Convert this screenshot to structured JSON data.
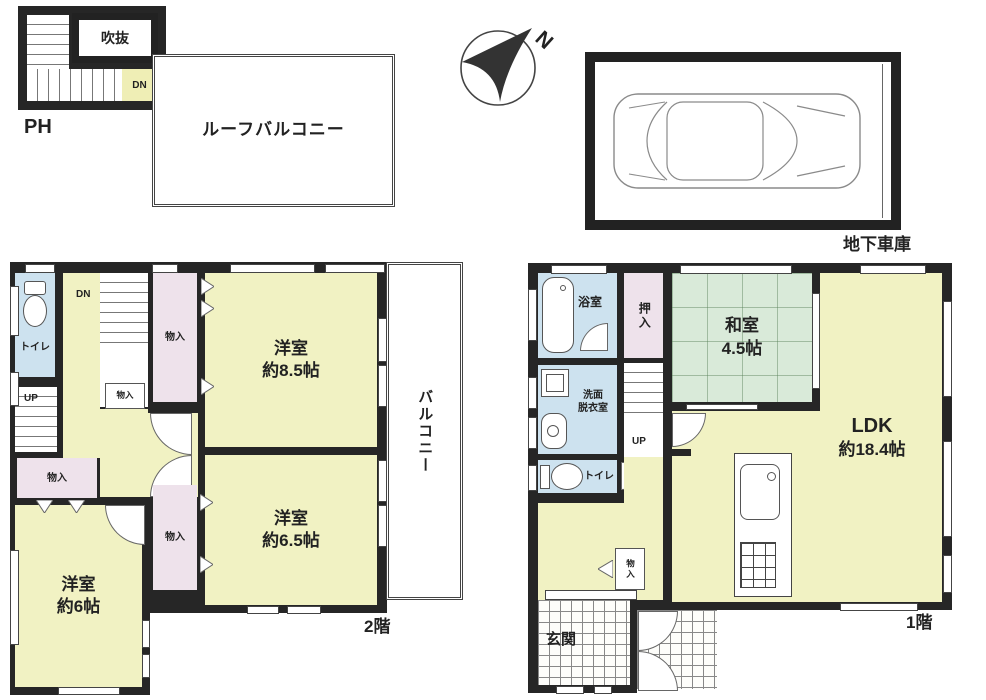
{
  "colors": {
    "wall": "#262626",
    "yellow": "#f1f2c3",
    "pink": "#eee2eb",
    "blue": "#cde2ef",
    "green": "#d9ead9",
    "stairyellow": "#efeeb5",
    "paper": "#ffffff",
    "line": "#555555"
  },
  "penthouse": {
    "label": "PH",
    "void_label": "吹抜",
    "dn_label": "DN"
  },
  "roof_balcony": {
    "label": "ルーフバルコニー"
  },
  "compass": {
    "north_label": "N"
  },
  "garage": {
    "label": "地下車庫"
  },
  "floor2": {
    "floor_label": "2階",
    "toilet_label": "トイレ",
    "dn_label": "DN",
    "up_label": "UP",
    "closet_top_label": "物入",
    "closet_small_label": "物入",
    "closet_left_label": "物入",
    "closet_mid_label": "物入",
    "balcony_label": "バルコニー",
    "room_85": {
      "name": "洋室",
      "size": "約8.5帖"
    },
    "room_65": {
      "name": "洋室",
      "size": "約6.5帖"
    },
    "room_6": {
      "name": "洋室",
      "size": "約6帖"
    }
  },
  "floor1": {
    "floor_label": "1階",
    "bath_label": "浴室",
    "oshiire_label": "押入",
    "washroom_line1": "洗面",
    "washroom_line2": "脱衣室",
    "up_label": "UP",
    "toilet_label": "トイレ",
    "closet_label": "物入",
    "genkan_label": "玄関",
    "washitsu": {
      "name": "和室",
      "size": "4.5帖"
    },
    "ldk": {
      "name": "LDK",
      "size": "約18.4帖"
    }
  }
}
